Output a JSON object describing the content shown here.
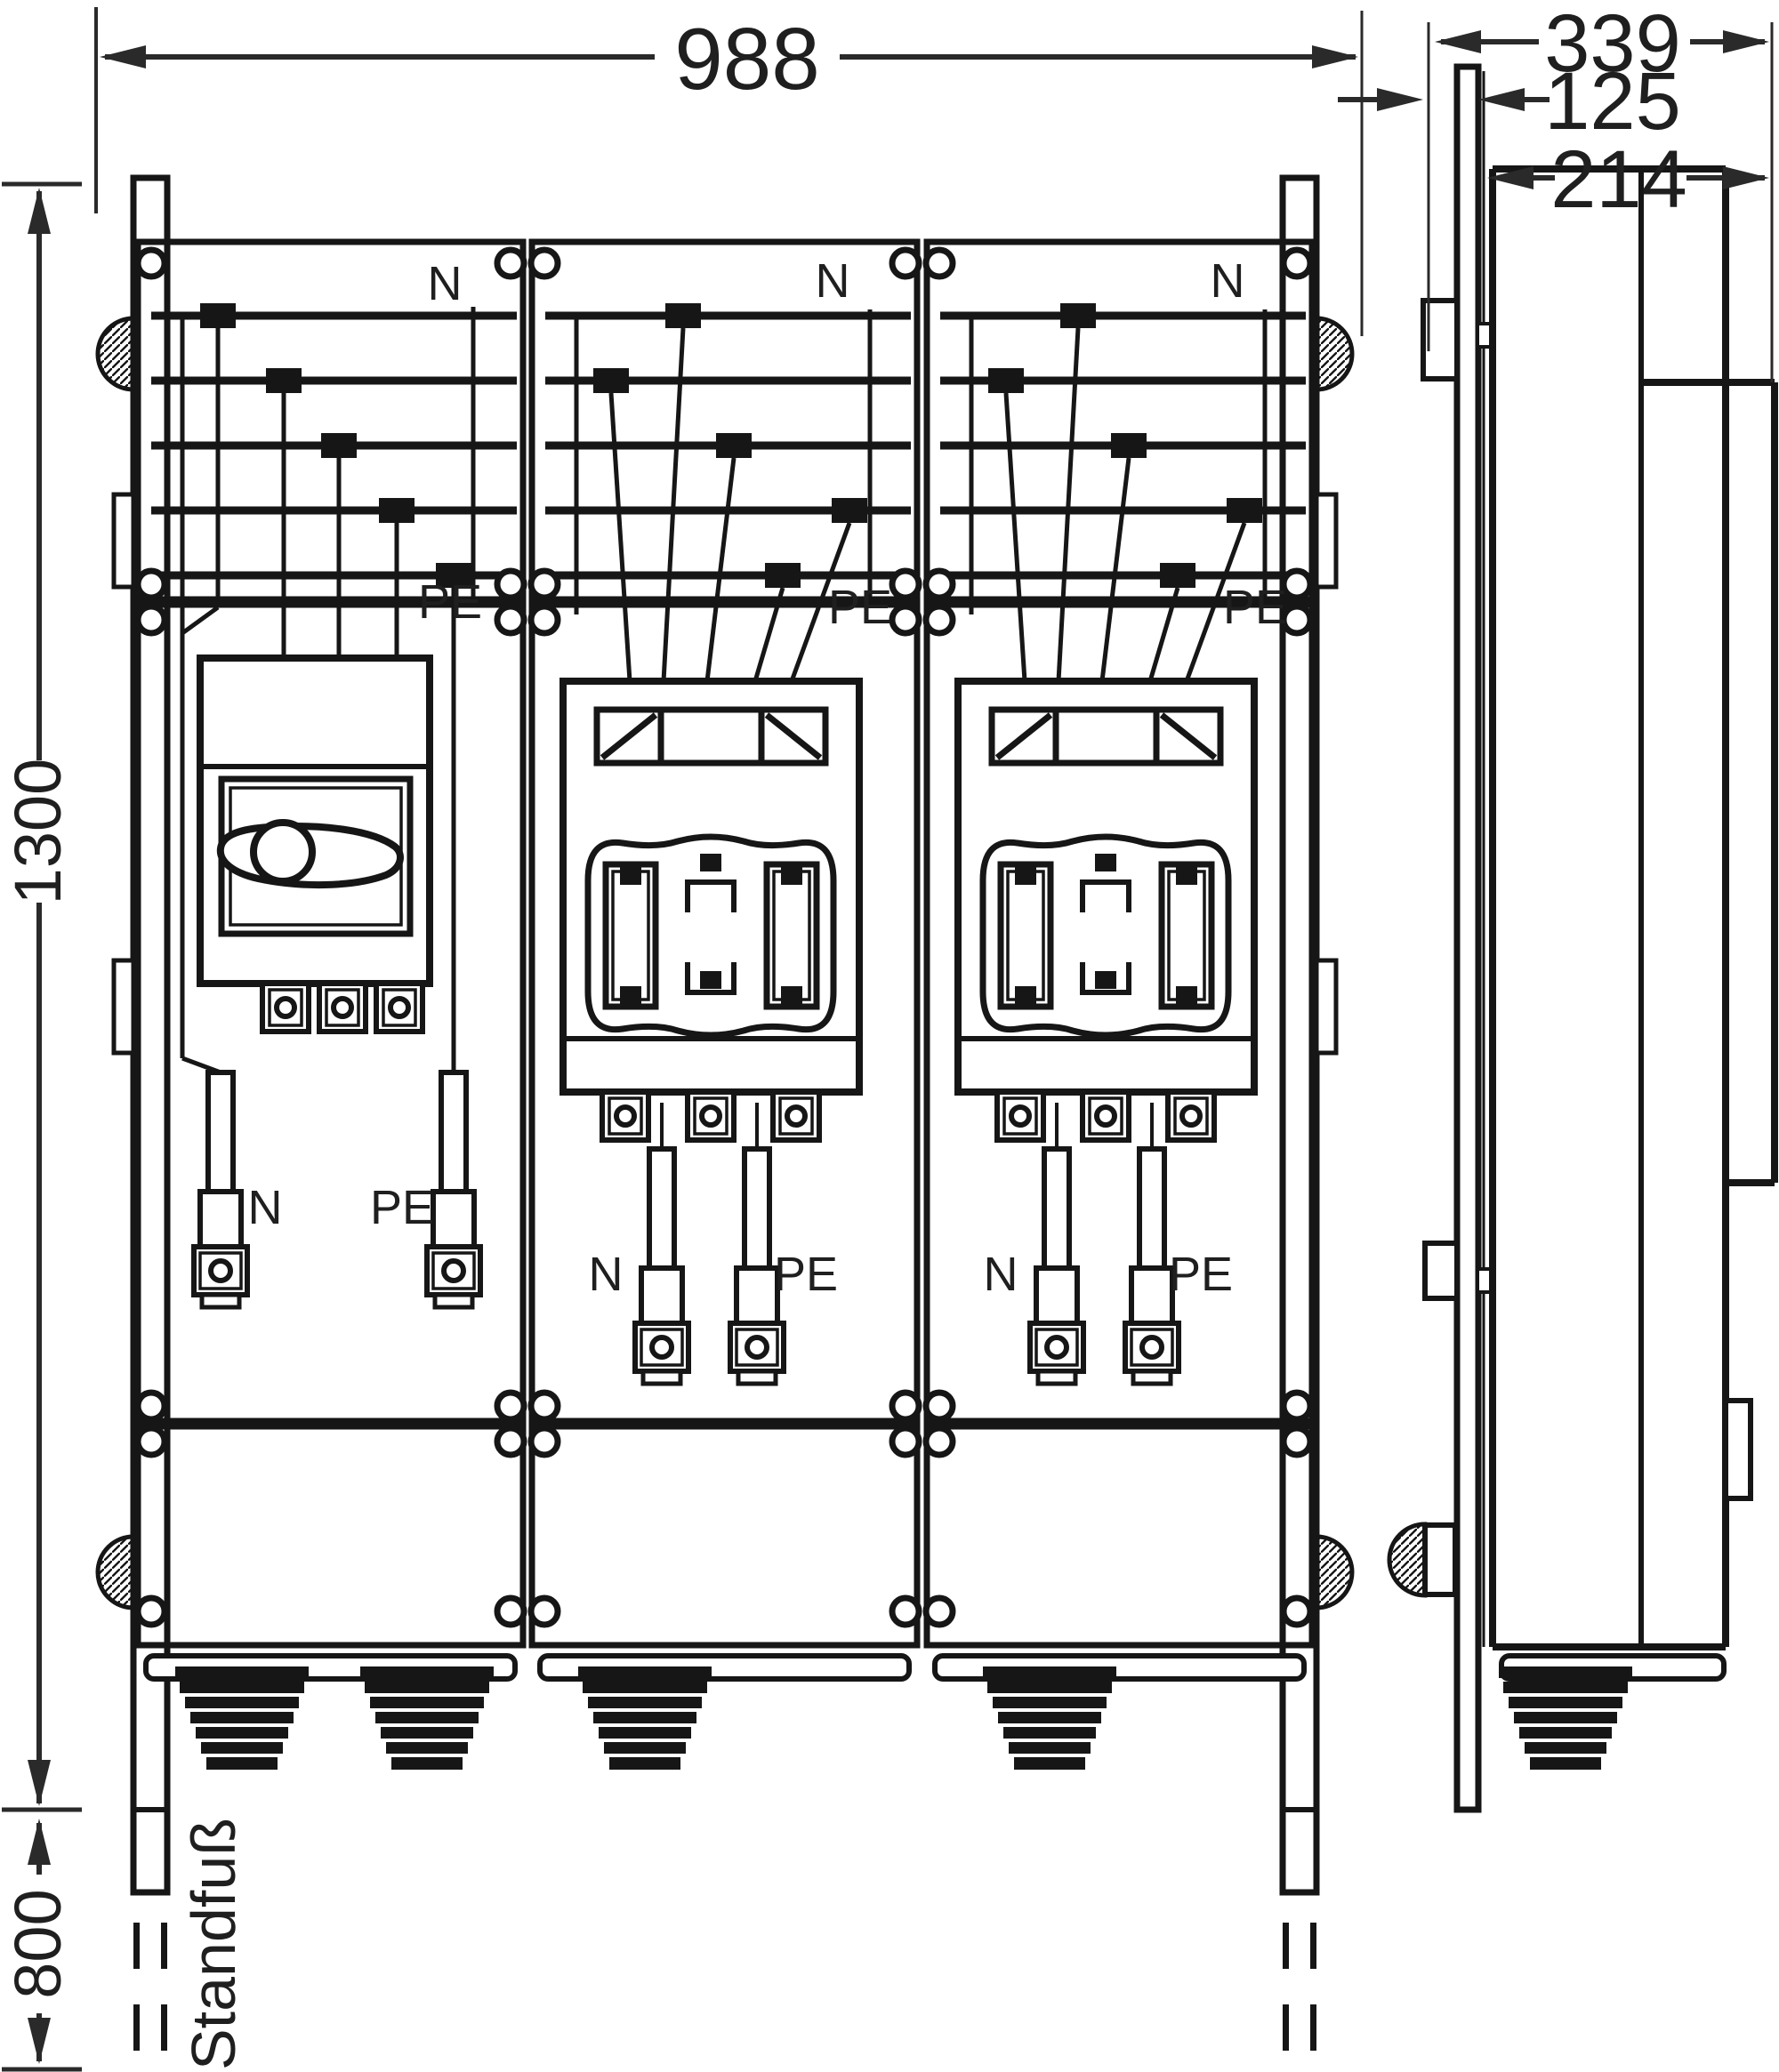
{
  "drawing": {
    "title_hint": "enclosure dimensional drawing, front and side view",
    "dimensions": {
      "overall_width": "988",
      "overall_depth": "339",
      "mounting_depth": "125",
      "body_depth": "214",
      "enclosure_height": "1300",
      "stand_height": "800"
    },
    "stand_label": "Standfuß",
    "panels": [
      {
        "busbar_neutral_label": "N",
        "busbar_pe_label": "PE",
        "outlet_neutral_label": "N",
        "outlet_pe_label": "PE"
      },
      {
        "busbar_neutral_label": "N",
        "busbar_pe_label": "PE",
        "outlet_neutral_label": "N",
        "outlet_pe_label": "PE"
      },
      {
        "busbar_neutral_label": "N",
        "busbar_pe_label": "PE",
        "outlet_neutral_label": "N",
        "outlet_pe_label": "PE"
      }
    ],
    "ink_color": "#161616",
    "dimension_color": "#2a2a2a"
  }
}
